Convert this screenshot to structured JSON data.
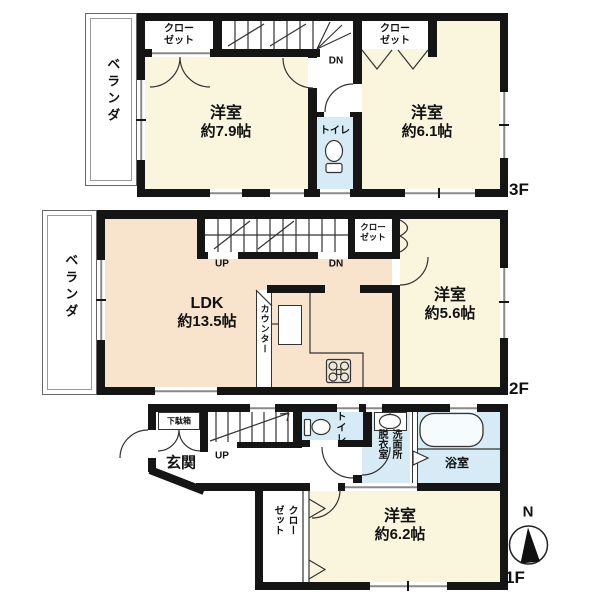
{
  "plan": {
    "floor3": {
      "label": "3F",
      "veranda": "ベランダ",
      "closet_left": {
        "line1": "クロー",
        "line2": "ゼット"
      },
      "closet_right": {
        "line1": "クロー",
        "line2": "ゼット"
      },
      "room_left": {
        "name": "洋室",
        "size": "約7.9帖"
      },
      "room_right": {
        "name": "洋室",
        "size": "約6.1帖"
      },
      "toilet": "トイレ",
      "stairs_down": "DN"
    },
    "floor2": {
      "label": "2F",
      "veranda": "ベランダ",
      "ldk": {
        "name": "LDK",
        "size": "約13.5帖"
      },
      "counter": "カウンター",
      "closet": {
        "line1": "クロー",
        "line2": "ゼット"
      },
      "room": {
        "name": "洋室",
        "size": "約5.6帖"
      },
      "stairs_up": "UP",
      "stairs_down": "DN"
    },
    "floor1": {
      "label": "1F",
      "entrance": "玄関",
      "shoe_cabinet": "下駄箱",
      "stairs_up": "UP",
      "toilet": "トイレ",
      "washroom": {
        "column_right": "洗面所",
        "column_left": "脱衣室"
      },
      "bathroom": "浴室",
      "closet": {
        "column_right": "クロー",
        "column_left": "ゼット"
      },
      "room": {
        "name": "洋室",
        "size": "約6.2帖"
      },
      "compass_north": "N"
    },
    "colors": {
      "wall": "#151515",
      "room": "#FAF6DE",
      "ldk": "#F8E3CC",
      "wet": "#D6EBF5"
    }
  }
}
